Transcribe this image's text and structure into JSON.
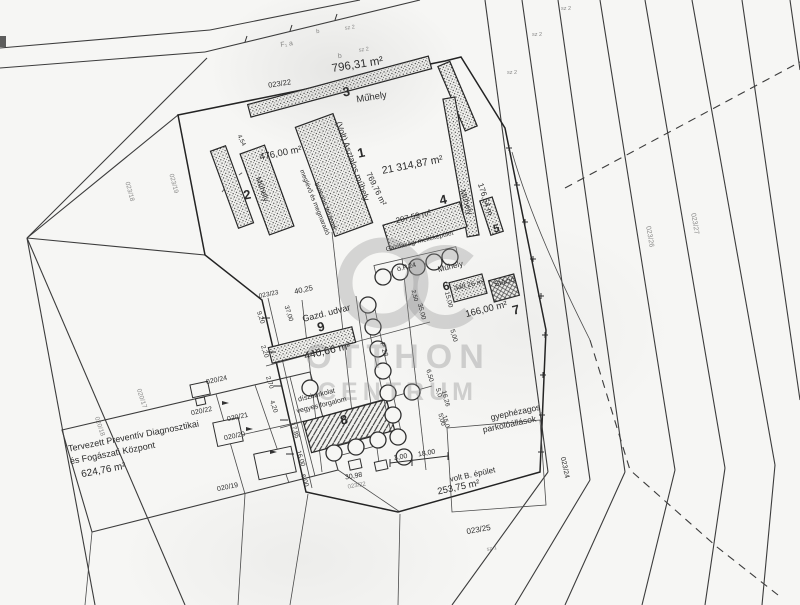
{
  "watermark": {
    "line1": "OTTHON",
    "line2": "CENTRUM"
  },
  "colors": {
    "paper": "#f6f6f4",
    "ink": "#2b2b2b",
    "line": "#3c3c3c",
    "watermark": "#949494"
  },
  "map_labels": [
    {
      "id": "code-f-a",
      "text": "F₁  a",
      "x": 287,
      "y": 46,
      "rot": -8,
      "fs": 7,
      "cls": "faint"
    },
    {
      "id": "code-b-top",
      "text": "b",
      "x": 318,
      "y": 33,
      "rot": -8,
      "fs": 6,
      "cls": "faint"
    },
    {
      "id": "code-sz2-top",
      "text": "sz 2",
      "x": 350,
      "y": 29,
      "rot": -8,
      "fs": 5.5,
      "cls": "faint"
    },
    {
      "id": "code-b",
      "text": "b",
      "x": 340,
      "y": 58,
      "rot": -8,
      "fs": 7,
      "cls": "faint"
    },
    {
      "id": "code-sz2",
      "text": "sz 2",
      "x": 364,
      "y": 51,
      "rot": -8,
      "fs": 5.5,
      "cls": "faint"
    },
    {
      "id": "area-796",
      "text": "796,31 m²",
      "x": 358,
      "y": 68,
      "rot": -9,
      "fs": 11.5,
      "cls": ""
    },
    {
      "id": "parcel-023-22",
      "text": "023/22",
      "x": 280,
      "y": 86,
      "rot": -9,
      "fs": 7.5,
      "cls": ""
    },
    {
      "id": "bldg-3-no",
      "text": "3",
      "x": 347,
      "y": 96,
      "rot": -9,
      "fs": 13,
      "cls": "big"
    },
    {
      "id": "bldg-3-name",
      "text": "Műhely",
      "x": 372,
      "y": 100,
      "rot": -9,
      "fs": 9.5,
      "cls": ""
    },
    {
      "id": "bldg-1-name",
      "text": "(Volt) Asztalos műhely",
      "x": 350,
      "y": 162,
      "rot": 70,
      "fs": 8.5,
      "cls": ""
    },
    {
      "id": "bldg-1-no",
      "text": "1",
      "x": 362,
      "y": 157,
      "rot": -12,
      "fs": 13,
      "cls": "big"
    },
    {
      "id": "area-21314",
      "text": "21 314,87 m²",
      "x": 413,
      "y": 168,
      "rot": -11,
      "fs": 10.5,
      "cls": ""
    },
    {
      "id": "area-769",
      "text": "769,76 m²",
      "x": 374,
      "y": 190,
      "rot": 64,
      "fs": 8,
      "cls": ""
    },
    {
      "id": "dim-454",
      "text": "4,54",
      "x": 240,
      "y": 141,
      "rot": 64,
      "fs": 6,
      "cls": ""
    },
    {
      "id": "area-476",
      "text": "476,00 m²",
      "x": 281,
      "y": 156,
      "rot": -11,
      "fs": 9.5,
      "cls": ""
    },
    {
      "id": "bldg-2-no",
      "text": "2",
      "x": 248,
      "y": 199,
      "rot": -12,
      "fs": 13,
      "cls": "big"
    },
    {
      "id": "bldg-2-name",
      "text": "Műhely",
      "x": 260,
      "y": 190,
      "rot": 70,
      "fs": 8,
      "cls": ""
    },
    {
      "id": "note-paved-1",
      "text": "meglévő és megmaradó",
      "x": 313,
      "y": 203,
      "rot": 68,
      "fs": 6.5,
      "cls": ""
    },
    {
      "id": "note-paved-2",
      "text": "burkolati felületek",
      "x": 324,
      "y": 207,
      "rot": 68,
      "fs": 6.5,
      "cls": ""
    },
    {
      "id": "bldg-4-no",
      "text": "4",
      "x": 444,
      "y": 204,
      "rot": -12,
      "fs": 13,
      "cls": "big"
    },
    {
      "id": "area-207",
      "text": "207,59 m²",
      "x": 414,
      "y": 219,
      "rot": -14,
      "fs": 8,
      "cls": ""
    },
    {
      "id": "bldg-4-name",
      "text": "Gazdasági melléképület",
      "x": 420,
      "y": 243,
      "rot": -14,
      "fs": 6.5,
      "cls": ""
    },
    {
      "id": "bldg-east-name",
      "text": "Műhely",
      "x": 464,
      "y": 203,
      "rot": 72,
      "fs": 8,
      "cls": ""
    },
    {
      "id": "dim-176",
      "text": "176,54 m",
      "x": 483,
      "y": 200,
      "rot": 72,
      "fs": 8,
      "cls": ""
    },
    {
      "id": "bldg-5-no",
      "text": "5",
      "x": 497,
      "y": 232,
      "rot": -12,
      "fs": 11,
      "cls": "big"
    },
    {
      "id": "bldg-row-name",
      "text": "Műhely",
      "x": 451,
      "y": 269,
      "rot": -14,
      "fs": 8,
      "cls": ""
    },
    {
      "id": "code-op24",
      "text": "ö.P.24",
      "x": 407,
      "y": 269,
      "rot": -14,
      "fs": 7,
      "cls": ""
    },
    {
      "id": "bldg-6-no",
      "text": "6",
      "x": 447,
      "y": 290,
      "rot": -14,
      "fs": 12,
      "cls": "big"
    },
    {
      "id": "area-348",
      "text": "348,26 m²",
      "x": 470,
      "y": 287,
      "rot": -14,
      "fs": 7,
      "cls": ""
    },
    {
      "id": "bldg-stacio",
      "text": "Stáció",
      "x": 505,
      "y": 284,
      "rot": -14,
      "fs": 7.5,
      "cls": ""
    },
    {
      "id": "area-166",
      "text": "166,00 m²",
      "x": 487,
      "y": 312,
      "rot": -14,
      "fs": 9.5,
      "cls": ""
    },
    {
      "id": "bldg-7-no",
      "text": "7",
      "x": 517,
      "y": 314,
      "rot": -14,
      "fs": 13,
      "cls": "big"
    },
    {
      "id": "parcel-023-23",
      "text": "023/23",
      "x": 269,
      "y": 296,
      "rot": -12,
      "fs": 6.5,
      "cls": ""
    },
    {
      "id": "dim-4025",
      "text": "40,25",
      "x": 304,
      "y": 292,
      "rot": -12,
      "fs": 7.5,
      "cls": ""
    },
    {
      "id": "yard-name",
      "text": "Gazd. udvar",
      "x": 327,
      "y": 316,
      "rot": -14,
      "fs": 9,
      "cls": ""
    },
    {
      "id": "bldg-9-no",
      "text": "9",
      "x": 322,
      "y": 331,
      "rot": -14,
      "fs": 13,
      "cls": "big"
    },
    {
      "id": "area-440",
      "text": "440,66 m²",
      "x": 328,
      "y": 354,
      "rot": -13,
      "fs": 10.5,
      "cls": ""
    },
    {
      "id": "code-p28",
      "text": "P 28",
      "x": 382,
      "y": 350,
      "rot": 75,
      "fs": 7,
      "cls": ""
    },
    {
      "id": "dim-250",
      "text": "2,50",
      "x": 413,
      "y": 296,
      "rot": 75,
      "fs": 6,
      "cls": ""
    },
    {
      "id": "dim-3500",
      "text": "35,00",
      "x": 420,
      "y": 312,
      "rot": 75,
      "fs": 6.5,
      "cls": ""
    },
    {
      "id": "dim-1500",
      "text": "15,00",
      "x": 447,
      "y": 300,
      "rot": 75,
      "fs": 6.5,
      "cls": ""
    },
    {
      "id": "dim-500a",
      "text": "5,00",
      "x": 452,
      "y": 336,
      "rot": 75,
      "fs": 6.5,
      "cls": ""
    },
    {
      "id": "dim-650",
      "text": "6,50",
      "x": 428,
      "y": 376,
      "rot": 75,
      "fs": 6.5,
      "cls": ""
    },
    {
      "id": "dim-500b",
      "text": "5,00",
      "x": 440,
      "y": 420,
      "rot": 75,
      "fs": 6.5,
      "cls": ""
    },
    {
      "id": "dim-1626",
      "text": "16,26",
      "x": 444,
      "y": 399,
      "rot": 75,
      "fs": 6.5,
      "cls": ""
    },
    {
      "id": "dim-920",
      "text": "9,20",
      "x": 259,
      "y": 318,
      "rot": 72,
      "fs": 6.5,
      "cls": ""
    },
    {
      "id": "dim-3700",
      "text": "37,00",
      "x": 287,
      "y": 314,
      "rot": 72,
      "fs": 6.5,
      "cls": ""
    },
    {
      "id": "dim-220",
      "text": "2,20",
      "x": 263,
      "y": 352,
      "rot": 72,
      "fs": 6.5,
      "cls": ""
    },
    {
      "id": "dim-270",
      "text": "2,70",
      "x": 268,
      "y": 383,
      "rot": 72,
      "fs": 6.5,
      "cls": ""
    },
    {
      "id": "dim-420",
      "text": "4,20",
      "x": 272,
      "y": 407,
      "rot": 72,
      "fs": 6.5,
      "cls": ""
    },
    {
      "id": "dim-1785",
      "text": "17,85",
      "x": 293,
      "y": 431,
      "rot": 72,
      "fs": 6.5,
      "cls": ""
    },
    {
      "id": "dim-1600",
      "text": "16,00",
      "x": 299,
      "y": 459,
      "rot": 72,
      "fs": 6.5,
      "cls": ""
    },
    {
      "id": "dim-600",
      "text": "6,00",
      "x": 303,
      "y": 481,
      "rot": 72,
      "fs": 6.5,
      "cls": ""
    },
    {
      "id": "note-pave-1",
      "text": "díszburkolat",
      "x": 317,
      "y": 397,
      "rot": -14,
      "fs": 7,
      "cls": ""
    },
    {
      "id": "note-pave-2",
      "text": "vegyes forgalom",
      "x": 322,
      "y": 407,
      "rot": -14,
      "fs": 7,
      "cls": ""
    },
    {
      "id": "bldg-8-no",
      "text": "8",
      "x": 345,
      "y": 424,
      "rot": -14,
      "fs": 13,
      "cls": "big"
    },
    {
      "id": "dim-3098",
      "text": "30,98",
      "x": 354,
      "y": 478,
      "rot": -10,
      "fs": 7,
      "cls": ""
    },
    {
      "id": "parcel-023-22b",
      "text": "023/22",
      "x": 357,
      "y": 487,
      "rot": -10,
      "fs": 6,
      "cls": "faint"
    },
    {
      "id": "dim-300",
      "text": "3,00",
      "x": 401,
      "y": 459,
      "rot": -10,
      "fs": 7,
      "cls": ""
    },
    {
      "id": "dim-1800",
      "text": "18,00",
      "x": 427,
      "y": 455,
      "rot": -10,
      "fs": 7,
      "cls": ""
    },
    {
      "id": "dim-150",
      "text": "15,0",
      "x": 444,
      "y": 422,
      "rot": 75,
      "fs": 6.5,
      "cls": ""
    },
    {
      "id": "dim-50",
      "text": "5,0",
      "x": 437,
      "y": 393,
      "rot": 75,
      "fs": 6.5,
      "cls": ""
    },
    {
      "id": "old-bldg-name",
      "text": "volt B. épület",
      "x": 473,
      "y": 477,
      "rot": -12,
      "fs": 8,
      "cls": ""
    },
    {
      "id": "area-253",
      "text": "253,75 m²",
      "x": 459,
      "y": 490,
      "rot": -12,
      "fs": 9.5,
      "cls": ""
    },
    {
      "id": "parking-1",
      "text": "gyephézagos",
      "x": 516,
      "y": 415,
      "rot": -12,
      "fs": 8.5,
      "cls": ""
    },
    {
      "id": "parking-2",
      "text": "parkolóállások",
      "x": 510,
      "y": 427,
      "rot": -12,
      "fs": 8.5,
      "cls": ""
    },
    {
      "id": "parcel-023-24",
      "text": "023/24",
      "x": 563,
      "y": 468,
      "rot": 78,
      "fs": 7,
      "cls": ""
    },
    {
      "id": "parcel-023-25",
      "text": "023/25",
      "x": 479,
      "y": 532,
      "rot": -10,
      "fs": 8,
      "cls": ""
    },
    {
      "id": "code-sz1",
      "text": "sz 1",
      "x": 492,
      "y": 550,
      "rot": -10,
      "fs": 5.5,
      "cls": "faint"
    },
    {
      "id": "parcel-020-24",
      "text": "020/24",
      "x": 217,
      "y": 382,
      "rot": -12,
      "fs": 7,
      "cls": ""
    },
    {
      "id": "parcel-020-22",
      "text": "020/22",
      "x": 202,
      "y": 413,
      "rot": -12,
      "fs": 7,
      "cls": ""
    },
    {
      "id": "parcel-020-21",
      "text": "020/21",
      "x": 238,
      "y": 419,
      "rot": -12,
      "fs": 7,
      "cls": ""
    },
    {
      "id": "parcel-020-20",
      "text": "020/20",
      "x": 235,
      "y": 438,
      "rot": -12,
      "fs": 7,
      "cls": ""
    },
    {
      "id": "parcel-020-19",
      "text": "020/19",
      "x": 228,
      "y": 489,
      "rot": -12,
      "fs": 7,
      "cls": ""
    },
    {
      "id": "plan-title-1",
      "text": "Tervezett Preventív Diagnosztikai",
      "x": 134,
      "y": 439,
      "rot": -11,
      "fs": 9,
      "cls": ""
    },
    {
      "id": "plan-title-2",
      "text": "és Fogászati Központ",
      "x": 113,
      "y": 456,
      "rot": -11,
      "fs": 9,
      "cls": ""
    },
    {
      "id": "area-624",
      "text": "624,76 m²",
      "x": 104,
      "y": 473,
      "rot": -11,
      "fs": 10,
      "cls": ""
    },
    {
      "id": "parcel-023-26",
      "text": "023/26",
      "x": 648,
      "y": 237,
      "rot": 80,
      "fs": 7,
      "cls": "faint"
    },
    {
      "id": "parcel-023-27",
      "text": "023/27",
      "x": 693,
      "y": 224,
      "rot": 80,
      "fs": 7,
      "cls": "faint"
    },
    {
      "id": "parcel-023-18",
      "text": "023/18",
      "x": 128,
      "y": 192,
      "rot": 75,
      "fs": 6.5,
      "cls": "faint"
    },
    {
      "id": "parcel-023-19",
      "text": "023/19",
      "x": 172,
      "y": 184,
      "rot": 75,
      "fs": 6.5,
      "cls": "faint"
    },
    {
      "id": "parcel-020-18",
      "text": "020/18",
      "x": 98,
      "y": 427,
      "rot": 72,
      "fs": 6.5,
      "cls": "faint"
    },
    {
      "id": "parcel-020-17",
      "text": "020/17",
      "x": 140,
      "y": 399,
      "rot": 72,
      "fs": 6.5,
      "cls": "faint"
    },
    {
      "id": "code-sz2-r1",
      "text": "sz 2",
      "x": 566,
      "y": 10,
      "rot": 0,
      "fs": 5.5,
      "cls": "faint"
    },
    {
      "id": "code-sz2-r2",
      "text": "sz 2",
      "x": 537,
      "y": 36,
      "rot": 0,
      "fs": 5.5,
      "cls": "faint"
    },
    {
      "id": "code-sz2-r3",
      "text": "sz 2",
      "x": 512,
      "y": 74,
      "rot": 0,
      "fs": 5.5,
      "cls": "faint"
    }
  ]
}
